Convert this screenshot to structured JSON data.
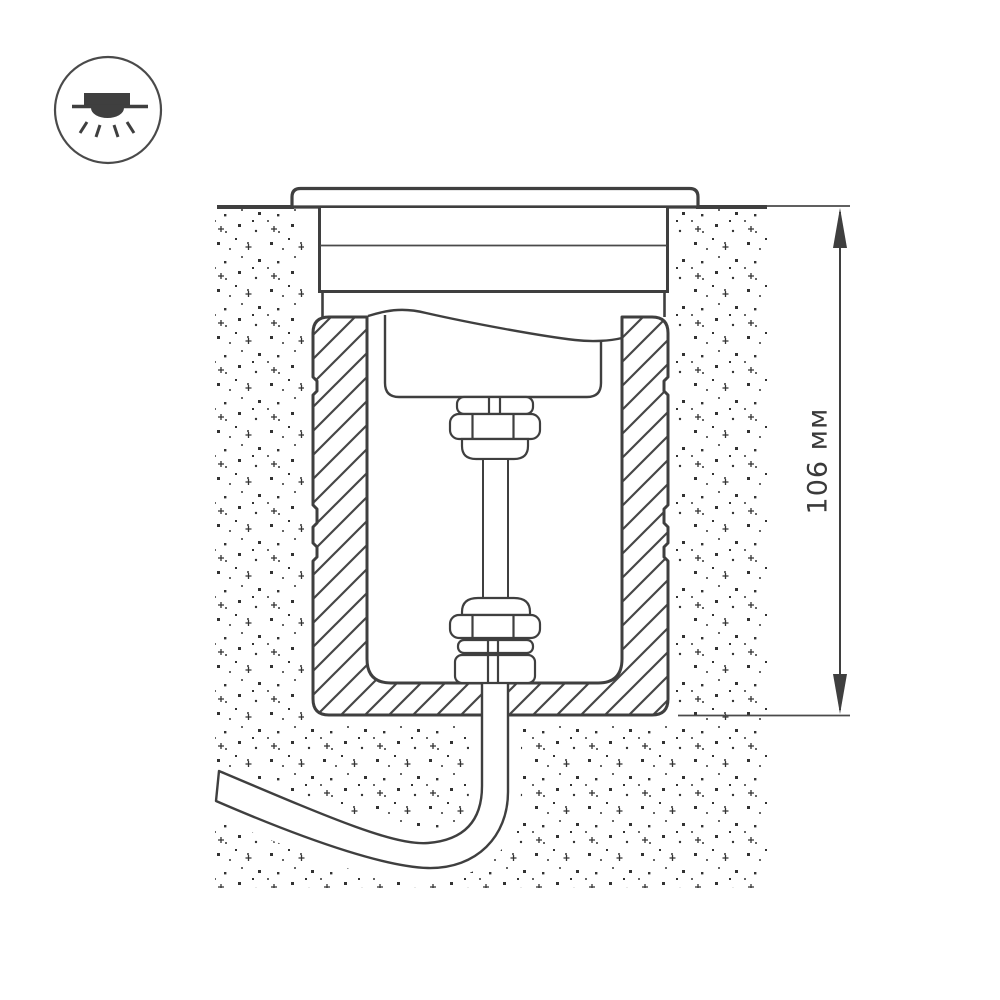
{
  "page": {
    "background": "#ffffff",
    "kind": "technical installation cross-section drawing of recessed ground luminaire"
  },
  "icon": {
    "name": "recessed-downlight-icon",
    "shape": "circle outline with flush-mounted light emitting rays downward"
  },
  "dimension": {
    "label": "106 мм",
    "value": 106,
    "unit": "мм",
    "orientation": "vertical",
    "measures": "depth below ground surface from surface line to bottom of mounting sleeve"
  },
  "colors": {
    "line": "#3f3f3f",
    "line_light": "#555555",
    "stipple": "#333333",
    "text": "#3a3a3a",
    "fill": "#ffffff",
    "background": "#ffffff"
  },
  "parts": {
    "flange": "surface trim ring",
    "housing": "upper luminaire housing",
    "sleeve": "buried mounting sleeve with hatched section walls",
    "lamp_unit": "inner lamp unit shown with break (wavy) line",
    "gland_top": "upper cable gland nut stack",
    "gland_bottom": "lower cable gland nut stack",
    "cable": "supply cable exiting through sleeve bottom and curving left",
    "ground": "stippled soil / concrete texture"
  }
}
